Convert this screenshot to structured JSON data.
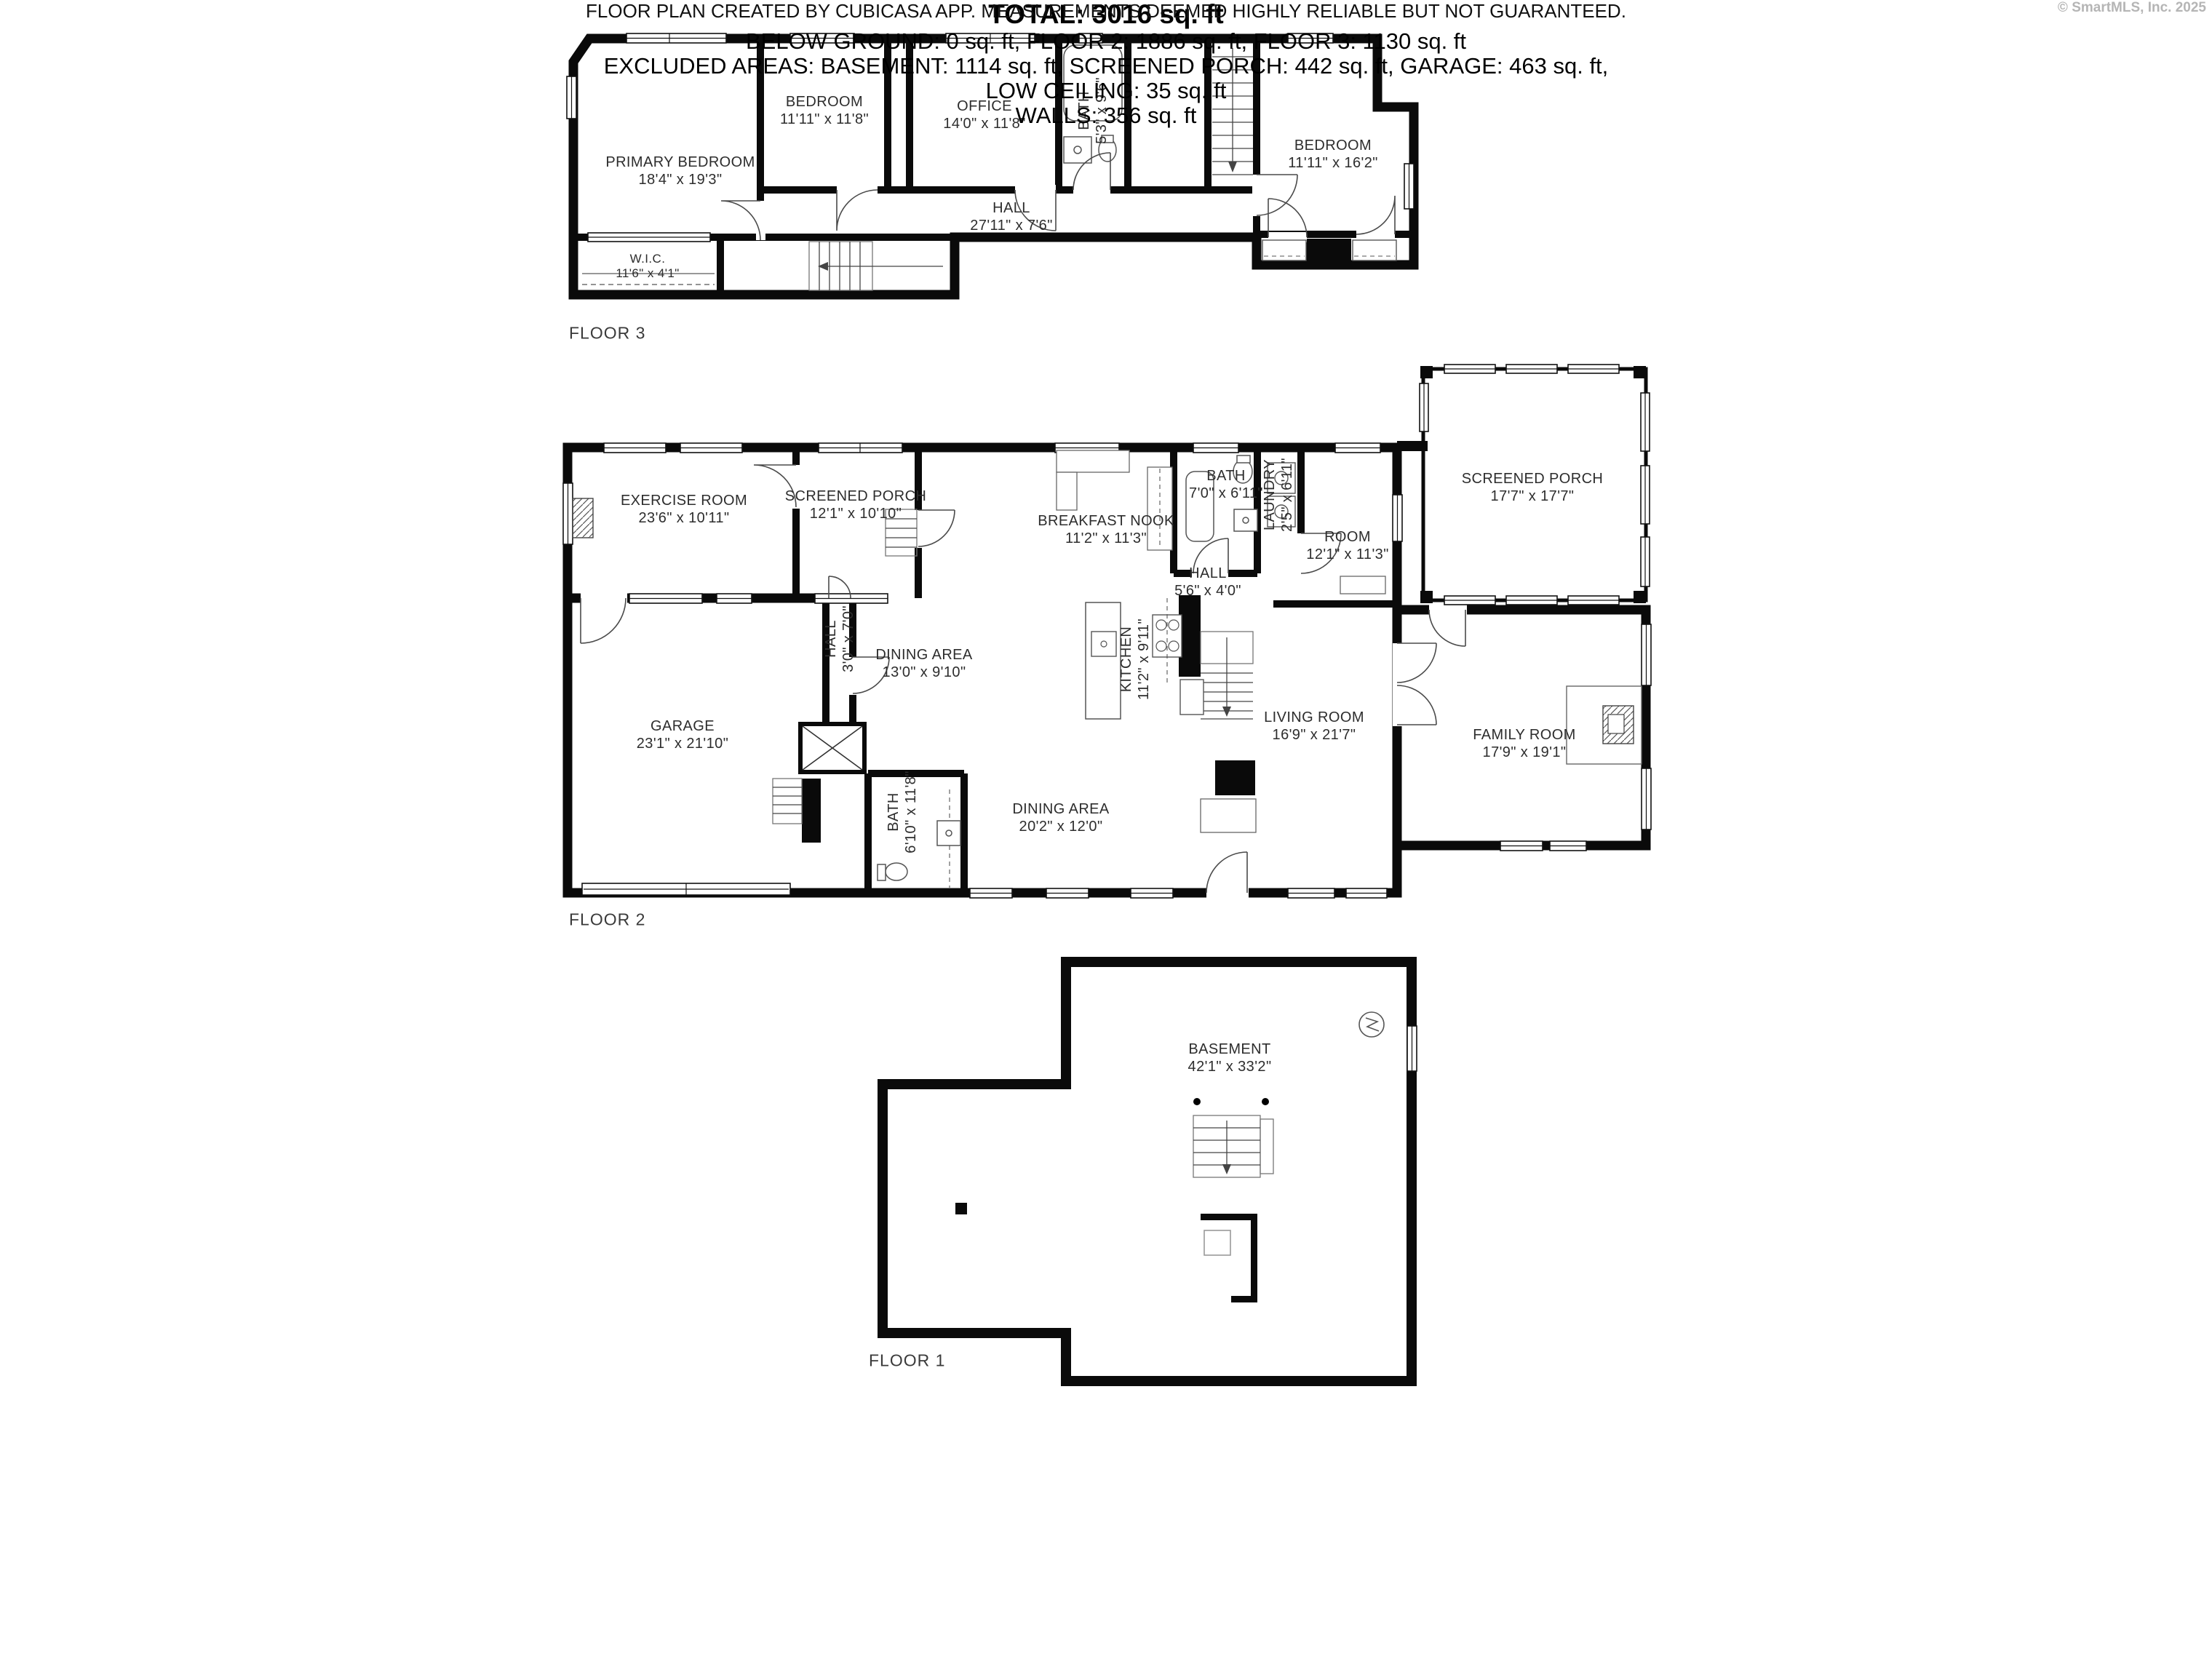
{
  "page": {
    "background": "#ffffff",
    "wall_color": "#0a0a0a"
  },
  "floors": [
    {
      "label": "FLOOR 3",
      "rooms": [
        {
          "name": "PRIMARY BEDROOM",
          "dims": "18'4\" x 19'3\""
        },
        {
          "name": "BEDROOM",
          "dims": "11'11\" x 11'8\""
        },
        {
          "name": "OFFICE",
          "dims": "14'0\" x 11'8\""
        },
        {
          "name": "BATH",
          "dims": "5'3\" x 9'6\""
        },
        {
          "name": "BEDROOM",
          "dims": "11'11\" x 16'2\""
        },
        {
          "name": "HALL",
          "dims": "27'11\" x 7'6\""
        },
        {
          "name": "W.I.C.",
          "dims": "11'6\" x 4'1\""
        }
      ]
    },
    {
      "label": "FLOOR 2",
      "rooms": [
        {
          "name": "EXERCISE ROOM",
          "dims": "23'6\" x 10'11\""
        },
        {
          "name": "SCREENED PORCH",
          "dims": "12'1\" x 10'10\""
        },
        {
          "name": "BREAKFAST NOOK",
          "dims": "11'2\" x 11'3\""
        },
        {
          "name": "BATH",
          "dims": "7'0\" x 6'11\""
        },
        {
          "name": "LAUNDRY",
          "dims": "2'5\" x 6'11\""
        },
        {
          "name": "ROOM",
          "dims": "12'1\" x 11'3\""
        },
        {
          "name": "HALL",
          "dims": "5'6\" x 4'0\""
        },
        {
          "name": "SCREENED PORCH",
          "dims": "17'7\" x 17'7\""
        },
        {
          "name": "GARAGE",
          "dims": "23'1\" x 21'10\""
        },
        {
          "name": "HALL",
          "dims": "3'0\" x 7'0\""
        },
        {
          "name": "DINING AREA",
          "dims": "13'0\" x 9'10\""
        },
        {
          "name": "KITCHEN",
          "dims": "11'2\" x 9'11\""
        },
        {
          "name": "LIVING ROOM",
          "dims": "16'9\" x 21'7\""
        },
        {
          "name": "FAMILY ROOM",
          "dims": "17'9\" x 19'1\""
        },
        {
          "name": "BATH",
          "dims": "6'10\" x 11'8\""
        },
        {
          "name": "DINING AREA",
          "dims": "20'2\" x 12'0\""
        }
      ]
    },
    {
      "label": "FLOOR 1",
      "rooms": [
        {
          "name": "BASEMENT",
          "dims": "42'1\" x 33'2\""
        }
      ]
    }
  ],
  "summary": {
    "total": "TOTAL: 3016 sq. ft",
    "by_floor": "BELOW GROUND: 0 sq. ft, FLOOR 2: 1886 sq. ft, FLOOR 3: 1130 sq. ft",
    "excluded": "EXCLUDED AREAS: BASEMENT: 1114 sq. ft, SCREENED PORCH: 442 sq. ft, GARAGE: 463 sq. ft,",
    "low_ceiling": "LOW CEILING: 35 sq. ft",
    "walls": "WALLS: 356 sq. ft"
  },
  "disclaimer": "FLOOR PLAN CREATED BY CUBICASA APP. MEASUREMENTS DEEMED HIGHLY RELIABLE BUT NOT GUARANTEED.",
  "branding": {
    "copyright": "© SmartMLS, Inc. 2025"
  }
}
